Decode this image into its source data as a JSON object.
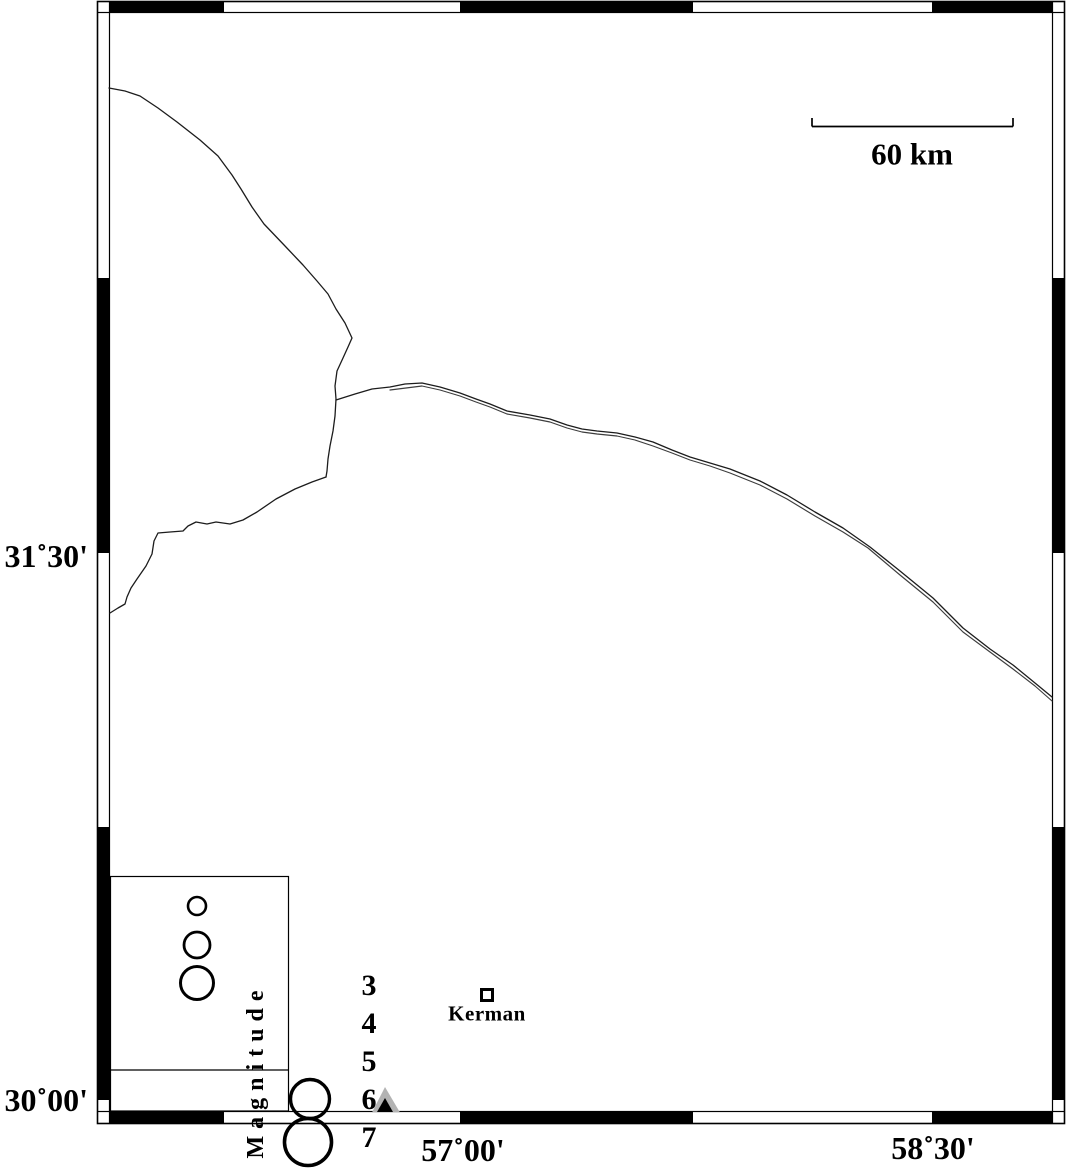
{
  "figure": {
    "kind": "seismotectonic map with fault traces, city marker, station triangle and magnitude legend"
  },
  "axes": {
    "latitude_labels": [
      {
        "text": "31˚30'",
        "y": 556
      },
      {
        "text": "30˚00'",
        "y": 1100
      }
    ],
    "longitude_labels": [
      {
        "text": "57˚00'",
        "x": 463,
        "y": 1150
      },
      {
        "text": "58˚30'",
        "x": 933,
        "y": 1148
      }
    ]
  },
  "scale_bar": {
    "label": "60 km",
    "length_km": 60
  },
  "city": {
    "label": "Kerman"
  },
  "legend": {
    "title": "Magnitude",
    "items": [
      {
        "label": "3"
      },
      {
        "label": "4"
      },
      {
        "label": "5"
      },
      {
        "label": "6"
      },
      {
        "label": "7"
      }
    ]
  },
  "colors": {
    "ink": "#000000",
    "station_gray": "#b3b3b3",
    "background": "#ffffff"
  }
}
